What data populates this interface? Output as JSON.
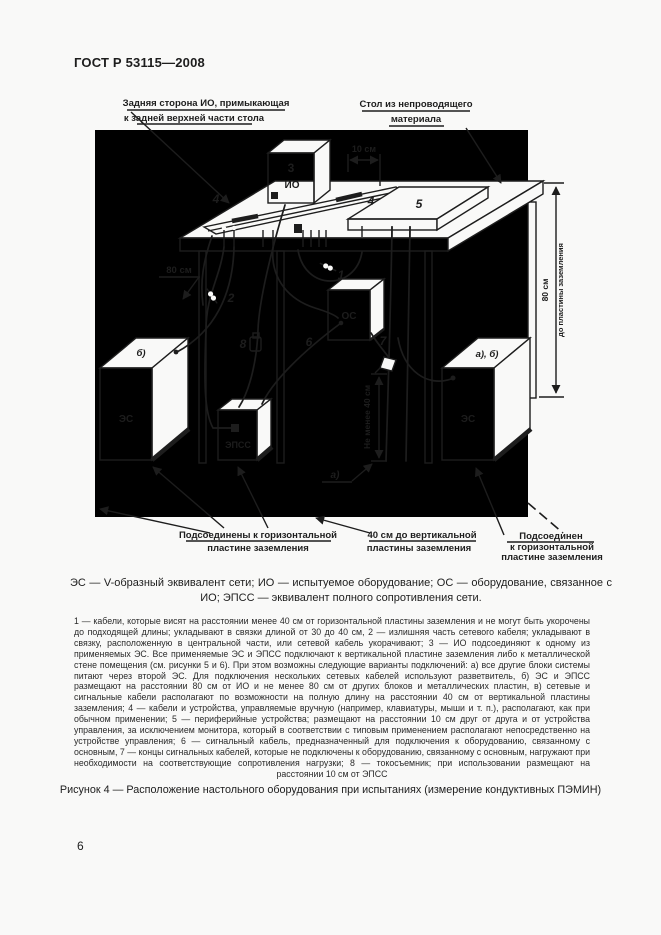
{
  "page": {
    "header": "ГОСТ Р 53115—2008",
    "page_number": "6"
  },
  "colors": {
    "ink": "#1d1d1d",
    "paper": "#f9f9f8"
  },
  "legend": "ЭС — V-образный эквивалент сети; ИО — испытуемое оборудование; ОС — оборудование, связанное с ИО; ЭПСС — эквивалент полного сопротивления сети.",
  "footnote": "1 — кабели, которые висят на расстоянии менее 40 см от горизонтальной пластины заземления и не могут быть укорочены до подходящей длины; укладывают в связки длиной от 30 до 40 см, 2 — излишняя часть сетевого кабеля; укладывают в связку, расположенную в центральной части, или сетевой кабель укорачивают; 3 — ИО подсоединяют к одному из применяемых ЭС. Все применяемые ЭС и ЭПСС подключают к вертикальной пластине заземления либо к металлической стене помещения (см. рисунки 5 и 6). При этом возможны следующие варианты подключений: а) все другие блоки системы питают через второй ЭС. Для подключения нескольких сетевых кабелей используют разветвитель, б) ЭС и ЭПСС размещают на расстоянии 80 см от ИО и не менее 80 см от других блоков и металлических пластин, в) сетевые и сигнальные кабели располагают по возможности на полную длину на расстоянии 40 см от вертикальной пластины заземления; 4 — кабели и устройства, управляемые вручную (например, клавиатуры, мыши и т. п.), располагают, как при обычном применении; 5 — периферийные устройства; размещают на расстоянии 10 см друг от друга и от устройства управления, за исключением монитора, который в соответствии с типовым применением располагают непосредственно на устройстве управления; 6 — сигнальный кабель, предназначенный для подключения к оборудованию, связанному с основным, 7 — концы сигнальных кабелей, которые не подключены к оборудованию, связанному с основным, нагружают при необходимости на соответствующие сопротивления нагрузки; 8 — токосъемник; при использовании размещают на расстоянии 10 см от ЭПСС",
  "caption": "Рисунок 4 — Расположение настольного оборудования при испытаниях (измерение кондуктивных ПЭМИН)",
  "diagram": {
    "callout_back": [
      "Задняя сторона ИО, примыкающая",
      "к задней верхней части стола"
    ],
    "callout_table": [
      "Стол из непроводящего",
      "материала"
    ],
    "callout_bl": [
      "Подсоединены к горизонтальной",
      "пластине заземления"
    ],
    "callout_bm": [
      "40 см до вертикальной",
      "пластины заземления"
    ],
    "callout_br": [
      "Подсоединен",
      "к горизонтальной",
      "пластине заземления"
    ],
    "dim_10": "10 см",
    "dim_80_left": "80 см",
    "dim_80_right": "80 см",
    "dim_80_right_sub": "до пластины заземления",
    "dim_40": "Не менее 40 см",
    "n1": "1",
    "n2": "2",
    "n4a": "4",
    "n4b": "4",
    "n5": "5",
    "n6": "6",
    "n7": "7",
    "n8": "8",
    "io_num": "3",
    "io": "ИО",
    "os": "ОС",
    "es": "ЭС",
    "epss": "ЭПСС",
    "v_a": "а)",
    "v_b": "б)",
    "v_ab": "а), б)"
  }
}
